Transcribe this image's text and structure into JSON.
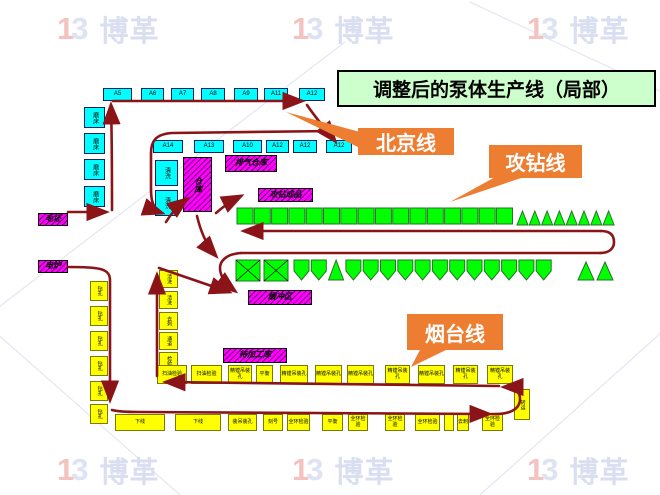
{
  "title": {
    "text": "调整后的泵体生产线（局部）"
  },
  "callouts": {
    "beijing": {
      "label": "北京线"
    },
    "gongzuan": {
      "label": "攻钻线"
    },
    "yantai": {
      "label": "烟台线"
    }
  },
  "watermark": {
    "logo_left": "1",
    "logo_right": "3",
    "brand": "博革",
    "positions": [
      [
        57,
        8
      ],
      [
        292,
        8
      ],
      [
        527,
        8
      ],
      [
        57,
        449
      ],
      [
        292,
        449
      ],
      [
        527,
        449
      ]
    ]
  },
  "colors": {
    "flow": "#8b1418",
    "callout": "#ed7d31",
    "title_bg": "#ccffcc",
    "cyan": "#00ffff",
    "magenta": "#ff00ff",
    "green": "#00ff00",
    "yellow": "#ffff00"
  },
  "diagram": {
    "box_groups": [
      {
        "cls": "cyan",
        "name": "machine-a-row-top",
        "font": 6,
        "boxes": [
          [
            103,
            88,
            29,
            13,
            "A5"
          ],
          [
            141,
            88,
            23,
            13,
            "A6"
          ],
          [
            171,
            88,
            23,
            13,
            "A7"
          ],
          [
            201,
            88,
            24,
            13,
            "A8"
          ],
          [
            234,
            88,
            24,
            13,
            "A9"
          ],
          [
            264,
            88,
            24,
            13,
            "A11"
          ],
          [
            299,
            88,
            26,
            13,
            "A12"
          ]
        ]
      },
      {
        "cls": "cyan",
        "name": "machine-a-row-second",
        "font": 6,
        "boxes": [
          [
            153,
            140,
            30,
            13,
            "A14"
          ],
          [
            194,
            140,
            30,
            13,
            "A13"
          ],
          [
            233,
            140,
            29,
            13,
            "A10"
          ],
          [
            266,
            140,
            23,
            13,
            "A12"
          ],
          [
            293,
            140,
            24,
            13,
            "A12"
          ],
          [
            326,
            140,
            26,
            13,
            "A12"
          ]
        ]
      },
      {
        "cls": "cyan",
        "name": "machine-left-column",
        "font": 6,
        "vertical": true,
        "boxes": [
          [
            84,
            107,
            21,
            21,
            "磨床"
          ],
          [
            84,
            133,
            21,
            21,
            "磨床"
          ],
          [
            84,
            159,
            21,
            21,
            "磨床"
          ],
          [
            84,
            186,
            21,
            21,
            "磨床"
          ]
        ]
      },
      {
        "cls": "cyan",
        "name": "machine-mid-column",
        "font": 6,
        "vertical": true,
        "boxes": [
          [
            155,
            160,
            23,
            26,
            "清洗"
          ],
          [
            155,
            190,
            23,
            26,
            "清洗"
          ]
        ]
      },
      {
        "cls": "magenta",
        "name": "storage-tall",
        "font": 8,
        "vertical": true,
        "boxes": [
          [
            183,
            157,
            29,
            55,
            "仓库"
          ]
        ]
      },
      {
        "cls": "magenta",
        "name": "storage-area",
        "font": 8,
        "boxes": [
          [
            225,
            155,
            52,
            17,
            "排气仓库"
          ],
          [
            258,
            188,
            55,
            14,
            "攻钻成品"
          ],
          [
            248,
            290,
            64,
            15,
            "缓冲区"
          ],
          [
            223,
            348,
            64,
            15,
            "待加工库"
          ],
          [
            38,
            213,
            30,
            13,
            "毛坯"
          ],
          [
            38,
            260,
            30,
            13,
            "电炉"
          ]
        ]
      },
      {
        "cls": "yellow",
        "name": "machine-yellow-left-column",
        "font": 5,
        "vertical": true,
        "boxes": [
          [
            90,
            281,
            18,
            20,
            "钻孔"
          ],
          [
            90,
            306,
            18,
            20,
            "钻孔"
          ],
          [
            90,
            331,
            18,
            20,
            "钻孔"
          ],
          [
            90,
            356,
            18,
            20,
            "钻孔"
          ],
          [
            90,
            381,
            18,
            20,
            "钻孔"
          ],
          [
            90,
            404,
            18,
            20,
            "钻孔"
          ]
        ]
      },
      {
        "cls": "yellow",
        "name": "machine-yellow-mid-column",
        "font": 5,
        "vertical": true,
        "boxes": [
          [
            159,
            270,
            19,
            18,
            "清洗"
          ],
          [
            159,
            291,
            19,
            18,
            "清洗"
          ],
          [
            159,
            312,
            19,
            18,
            "去刺"
          ],
          [
            159,
            332,
            19,
            18,
            "通道"
          ],
          [
            159,
            352,
            19,
            18,
            "检验"
          ]
        ]
      },
      {
        "cls": "yellow",
        "name": "yantai-row-upper",
        "font": 5,
        "boxes": [
          [
            157,
            365,
            30,
            19,
            "扫油检验"
          ],
          [
            191,
            365,
            31,
            19,
            "扫油检验"
          ],
          [
            228,
            365,
            24,
            19,
            "精镗吊装孔"
          ],
          [
            256,
            365,
            17,
            19,
            "平衡"
          ],
          [
            280,
            365,
            28,
            19,
            "精镗吊装孔"
          ],
          [
            315,
            365,
            27,
            19,
            "精镗吊装孔"
          ],
          [
            347,
            365,
            27,
            19,
            "精镗吊装孔"
          ],
          [
            385,
            365,
            25,
            19,
            "精镗吊装孔"
          ],
          [
            418,
            365,
            27,
            19,
            "精镗吊装孔"
          ],
          [
            453,
            365,
            25,
            19,
            "精镗吊装孔"
          ],
          [
            487,
            365,
            26,
            19,
            "精镗吊装孔"
          ]
        ]
      },
      {
        "cls": "yellow",
        "name": "yantai-row-lower",
        "font": 5,
        "boxes": [
          [
            115,
            414,
            50,
            17,
            "下线"
          ],
          [
            175,
            414,
            46,
            17,
            "下线"
          ],
          [
            228,
            414,
            29,
            17,
            "装吊装孔"
          ],
          [
            263,
            414,
            20,
            17,
            "刻号"
          ],
          [
            287,
            414,
            23,
            17,
            "全环检验"
          ],
          [
            322,
            414,
            21,
            17,
            "平衡"
          ],
          [
            348,
            414,
            20,
            17,
            "全环检验"
          ],
          [
            385,
            414,
            20,
            17,
            "全环检验"
          ],
          [
            415,
            414,
            25,
            17,
            "全环检验"
          ],
          [
            444,
            414,
            10,
            17,
            ""
          ],
          [
            457,
            414,
            12,
            17,
            "去刺"
          ],
          [
            482,
            414,
            21,
            17,
            "全环检验"
          ]
        ]
      },
      {
        "cls": "yellow",
        "name": "transfer-box",
        "font": 5,
        "vertical": true,
        "boxes": [
          [
            514,
            389,
            16,
            31,
            "转运"
          ]
        ]
      }
    ],
    "shape_runs": [
      {
        "type": "sq",
        "x": 237,
        "y": 208,
        "w": 16,
        "h": 16,
        "step": 17.3,
        "count": 16
      },
      {
        "type": "tri",
        "x": 517,
        "y": 211,
        "w": 11,
        "h": 14,
        "step": 12.3,
        "count": 8
      },
      {
        "type": "xsq",
        "x": 236,
        "y": 260,
        "w": 24,
        "h": 21,
        "step": 28,
        "count": 2
      },
      {
        "type": "run",
        "x": 294,
        "y": 260,
        "w": 15,
        "h": 20,
        "step": 17.3,
        "types": [
          "pent",
          "pent",
          "tri",
          "pent",
          "pent",
          "pent",
          "pent",
          "pent",
          "pent",
          "pent",
          "pent",
          "pent",
          "pent",
          "pent",
          "pent"
        ]
      },
      {
        "type": "tri",
        "x": 578,
        "y": 262,
        "w": 16,
        "h": 18,
        "step": 19,
        "count": 2
      }
    ],
    "flow_paths": [
      {
        "d": "M68,212 L106,212",
        "arrow": true
      },
      {
        "d": "M112,210 C112,175 112,140 111,105",
        "arrow": true
      },
      {
        "d": "M113,101 L302,101",
        "arrow": true
      },
      {
        "d": "M307,105 C315,117 327,131 335,141",
        "arrow": true
      },
      {
        "d": "M333,131 L172,133 C156,134 151,141 151,153 L151,190 C151,205 156,211 162,213",
        "arrow": true
      },
      {
        "d": "M166,222 C172,212 179,205 187,199",
        "arrow": true
      },
      {
        "d": "M197,216 C201,233 208,247 216,256",
        "arrow": true
      },
      {
        "d": "M216,213 C225,205 233,200 241,196",
        "arrow": true
      },
      {
        "d": "M159,268 L229,292",
        "arrow": true
      },
      {
        "d": "M601,231 L244,231",
        "arrow": true
      },
      {
        "d": "M600,253 C611,253 614,247 614,242 C614,236 611,231 601,231",
        "arrow": false
      },
      {
        "d": "M241,253 L601,253",
        "arrow": false
      },
      {
        "d": "M241,253 C225,254 220,262 220,268 C220,277 227,285 235,291",
        "arrow": true
      },
      {
        "d": "M68,267 C98,267 110,268 110,280 L110,400",
        "arrow": true
      },
      {
        "d": "M112,410 C120,412 130,412 140,412 L489,414",
        "arrow": true
      },
      {
        "d": "M491,414 C510,415 520,409 520,399 C520,390 513,387 504,387",
        "arrow": true
      },
      {
        "d": "M499,386 L166,382",
        "arrow": true
      },
      {
        "d": "M157,376 L157,275",
        "arrow": true
      }
    ],
    "callout_geo": {
      "beijing": {
        "box": [
          358,
          128,
          96,
          27
        ],
        "tail": "360,132 286,112 360,148"
      },
      "gongzuan": {
        "box": [
          489,
          145,
          93,
          33
        ],
        "tail": "497,176 450,202 527,176"
      },
      "yantai": {
        "box": [
          407,
          314,
          96,
          36
        ],
        "tail": "421,348 411,367 450,348"
      }
    },
    "lattice": [
      [
        -5,
        310,
        345,
        42
      ],
      [
        470,
        2,
        662,
        92
      ],
      [
        -5,
        332,
        180,
        495
      ],
      [
        480,
        495,
        662,
        332
      ]
    ]
  }
}
